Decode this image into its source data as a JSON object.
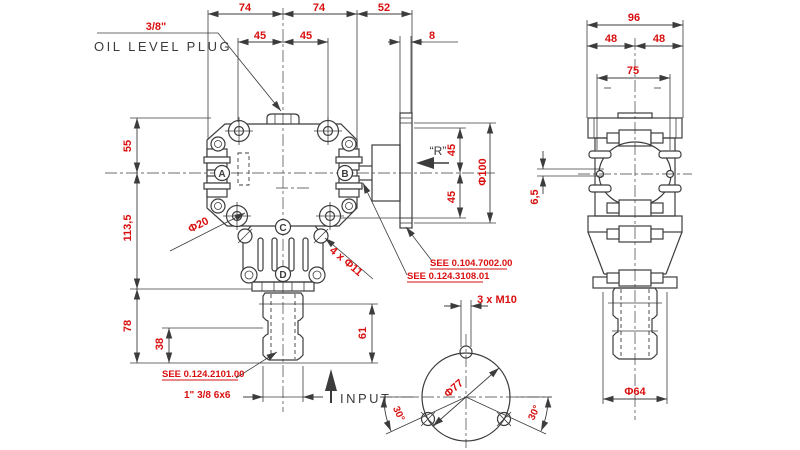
{
  "colors": {
    "dimension_text": "#d90f0f",
    "drawing_line": "#3c3c3c",
    "background": "#ffffff"
  },
  "callout": {
    "oil_plug_size": "3/8\"",
    "oil_plug_label": "OIL LEVEL PLUG",
    "rotation_mark": "“R”",
    "input_label": "INPUT"
  },
  "front_view": {
    "dims": {
      "top_left_74": "74",
      "top_right_74": "74",
      "top_52": "52",
      "bolt_45_left": "45",
      "bolt_45_right": "45",
      "flange_8": "8",
      "left_55": "55",
      "left_113_5": "113,5",
      "left_78": "78",
      "left_38": "38",
      "right_45_top": "45",
      "right_45_bottom": "45",
      "flange_dia": "Φ100",
      "shaft_61": "61"
    },
    "labels": {
      "washer_dia": "Φ20",
      "mount_holes": "4 x Φ11",
      "spline": "1\" 3/8 6x6",
      "ref_flange": "SEE 0.104.7002.00",
      "ref_shaft_b": "SEE 0.124.3108.01",
      "ref_input": "SEE 0.124.2101.00"
    },
    "balloons": [
      "A",
      "B",
      "C",
      "D"
    ]
  },
  "bottom_view": {
    "dims": {
      "bolt_circle_dia": "Φ77",
      "angle_left": "30°",
      "angle_right": "30°",
      "thread": "3 x M10"
    }
  },
  "side_view": {
    "dims": {
      "width_96": "96",
      "half_48_left": "48",
      "half_48_right": "48",
      "inner_75": "75",
      "notch_6_5": "6,5",
      "shaft_dia_64": "Φ64"
    }
  }
}
